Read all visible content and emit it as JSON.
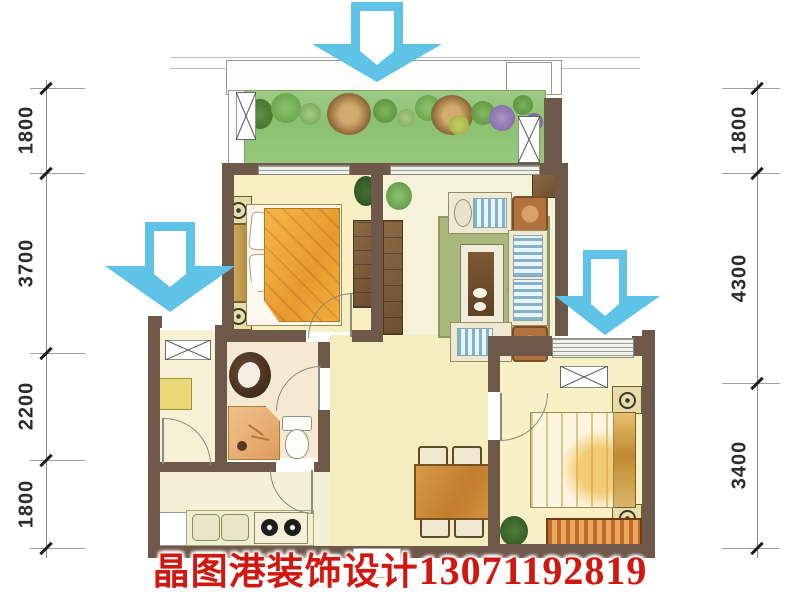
{
  "dimensions": {
    "left": [
      "1800",
      "3700",
      "2200",
      "1800"
    ],
    "right": [
      "1800",
      "4300",
      "3400"
    ]
  },
  "watermark": {
    "brand": "晶图港装饰设计",
    "phone": "13071192819"
  },
  "icons": {
    "flow_arrows": [
      "down-arrow-icon",
      "down-arrow-icon",
      "down-arrow-icon"
    ]
  },
  "colors": {
    "wall": "#6e5849",
    "balcony_green": "#8fc475",
    "arrow_blue": "#5fc3e7",
    "watermark_red": "#d01710",
    "floor_cream": "#f5efcf",
    "bed_blanket_orange": "#efa93f"
  }
}
